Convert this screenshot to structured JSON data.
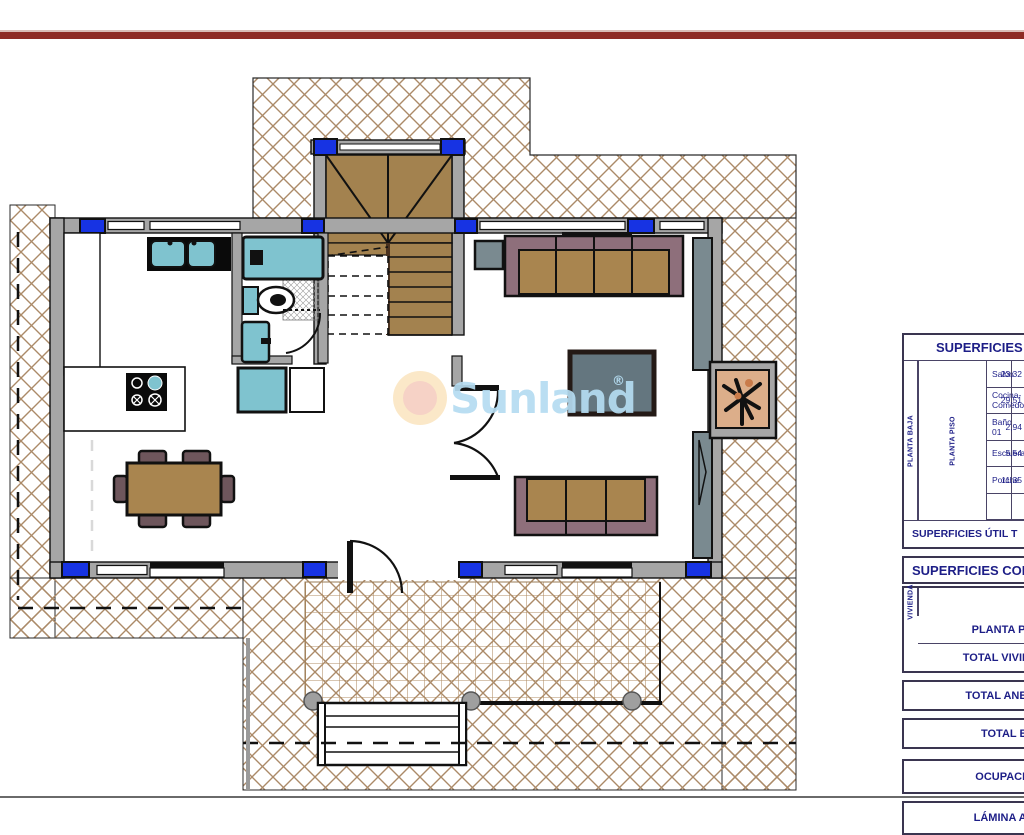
{
  "page": {
    "top_bar_color": "#8e2b25",
    "background": "#ffffff"
  },
  "watermark": {
    "brand": "Sunland",
    "registered": "®",
    "text_color": "#b5dcf1",
    "logo_outer_color": "#fbe7c4",
    "logo_inner_color": "#f6cfc2"
  },
  "plan": {
    "colors": {
      "hatch_brown": "#ab8a68",
      "tile_brown": "#b08d64",
      "wall_gray": "#a6a6a6",
      "column_blue": "#1733e3",
      "fixture_teal": "#7fc3cf",
      "wood_brown": "#a9854f",
      "upholstery_mauve": "#8e6f7b",
      "table_slate": "#64767f",
      "planter_tan": "#dcae8a"
    }
  },
  "tables": {
    "utiles": {
      "header": "SUPERFICIES",
      "left_vertical_label": "PLANTA BAJA",
      "right_vertical_label": "PLANTA PISO",
      "rows": [
        {
          "label": "Salón",
          "value": "23,32"
        },
        {
          "label": "Cocina-Comedor",
          "value": "29,51"
        },
        {
          "label": "Baño 01",
          "value": "2,94"
        },
        {
          "label": "Escalera",
          "value": "5,54"
        },
        {
          "label": "Porche",
          "value": "11,35"
        },
        {
          "label": "",
          "value": ""
        }
      ],
      "footer": "SUPERFICIES ÚTIL T"
    },
    "construidas": {
      "header": "SUPERFICIES CON",
      "group_vertical_label": "VIVIENDA",
      "group_rows": [
        "PLANTA BAJA",
        "PLANTA PISO",
        "TOTAL VIVIENDA"
      ],
      "single_rows": [
        "TOTAL ANEXO",
        "TOTAL EDIFICACIÓ",
        "OCUPACIÓN EDIFICA",
        "LÁMINA AGUA PISCIN"
      ]
    }
  }
}
